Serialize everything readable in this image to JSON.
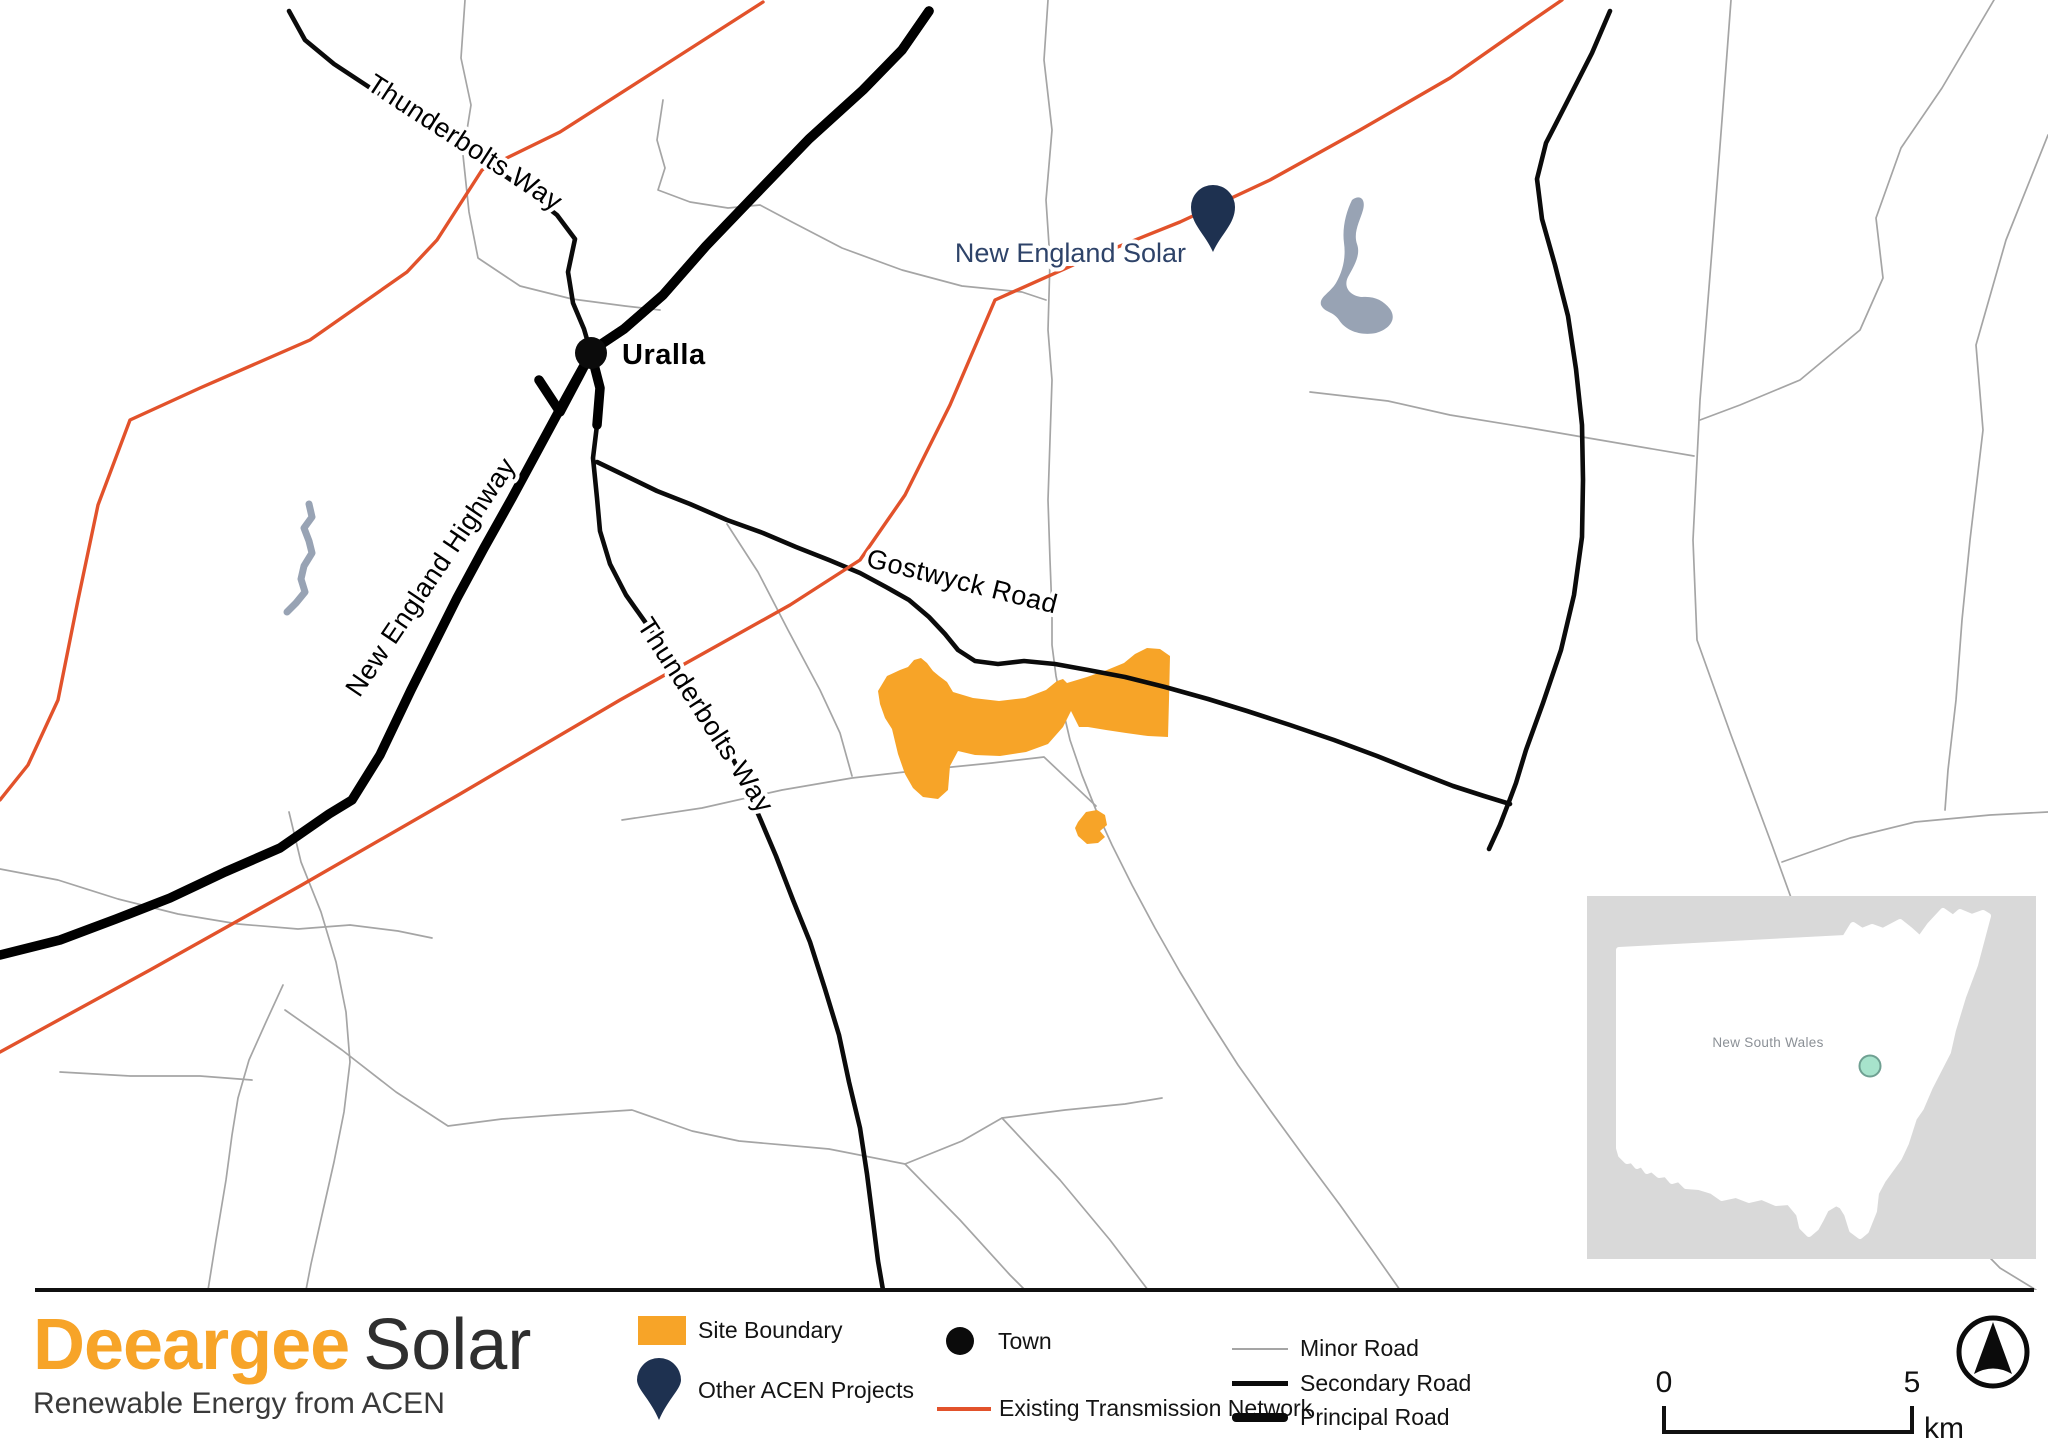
{
  "map": {
    "town": {
      "name": "Uralla"
    },
    "project_pin": {
      "label": "New England Solar"
    },
    "road_labels": {
      "thunderbolts_way_north": "Thunderbolts Way",
      "new_england_highway": "New England Highway",
      "thunderbolts_way_south": "Thunderbolts Way",
      "gostwyck_road": "Gostwyck Road"
    },
    "inset": {
      "region": "New South Wales"
    }
  },
  "legend": {
    "site_boundary": "Site Boundary",
    "other_acen_projects": "Other ACEN Projects",
    "town": "Town",
    "existing_transmission_network": "Existing Transmission Network",
    "minor_road": "Minor Road",
    "secondary_road": "Secondary Road",
    "principal_road": "Principal Road"
  },
  "logo": {
    "brand": "Deeargee",
    "suffix": "Solar",
    "tagline": "Renewable Energy from ACEN"
  },
  "scalebar": {
    "start": "0",
    "end": "5",
    "unit": "km"
  },
  "colors": {
    "site_boundary": "#F7A428",
    "transmission": "#E2522B",
    "acen_navy": "#1E3150",
    "water": "#98A3B4",
    "minor_road": "#A5A5A5",
    "road": "#000000",
    "inset_background": "#D9D9D9",
    "inset_marker_fill": "#A7E3CC",
    "inset_marker_stroke": "#6FA092"
  }
}
